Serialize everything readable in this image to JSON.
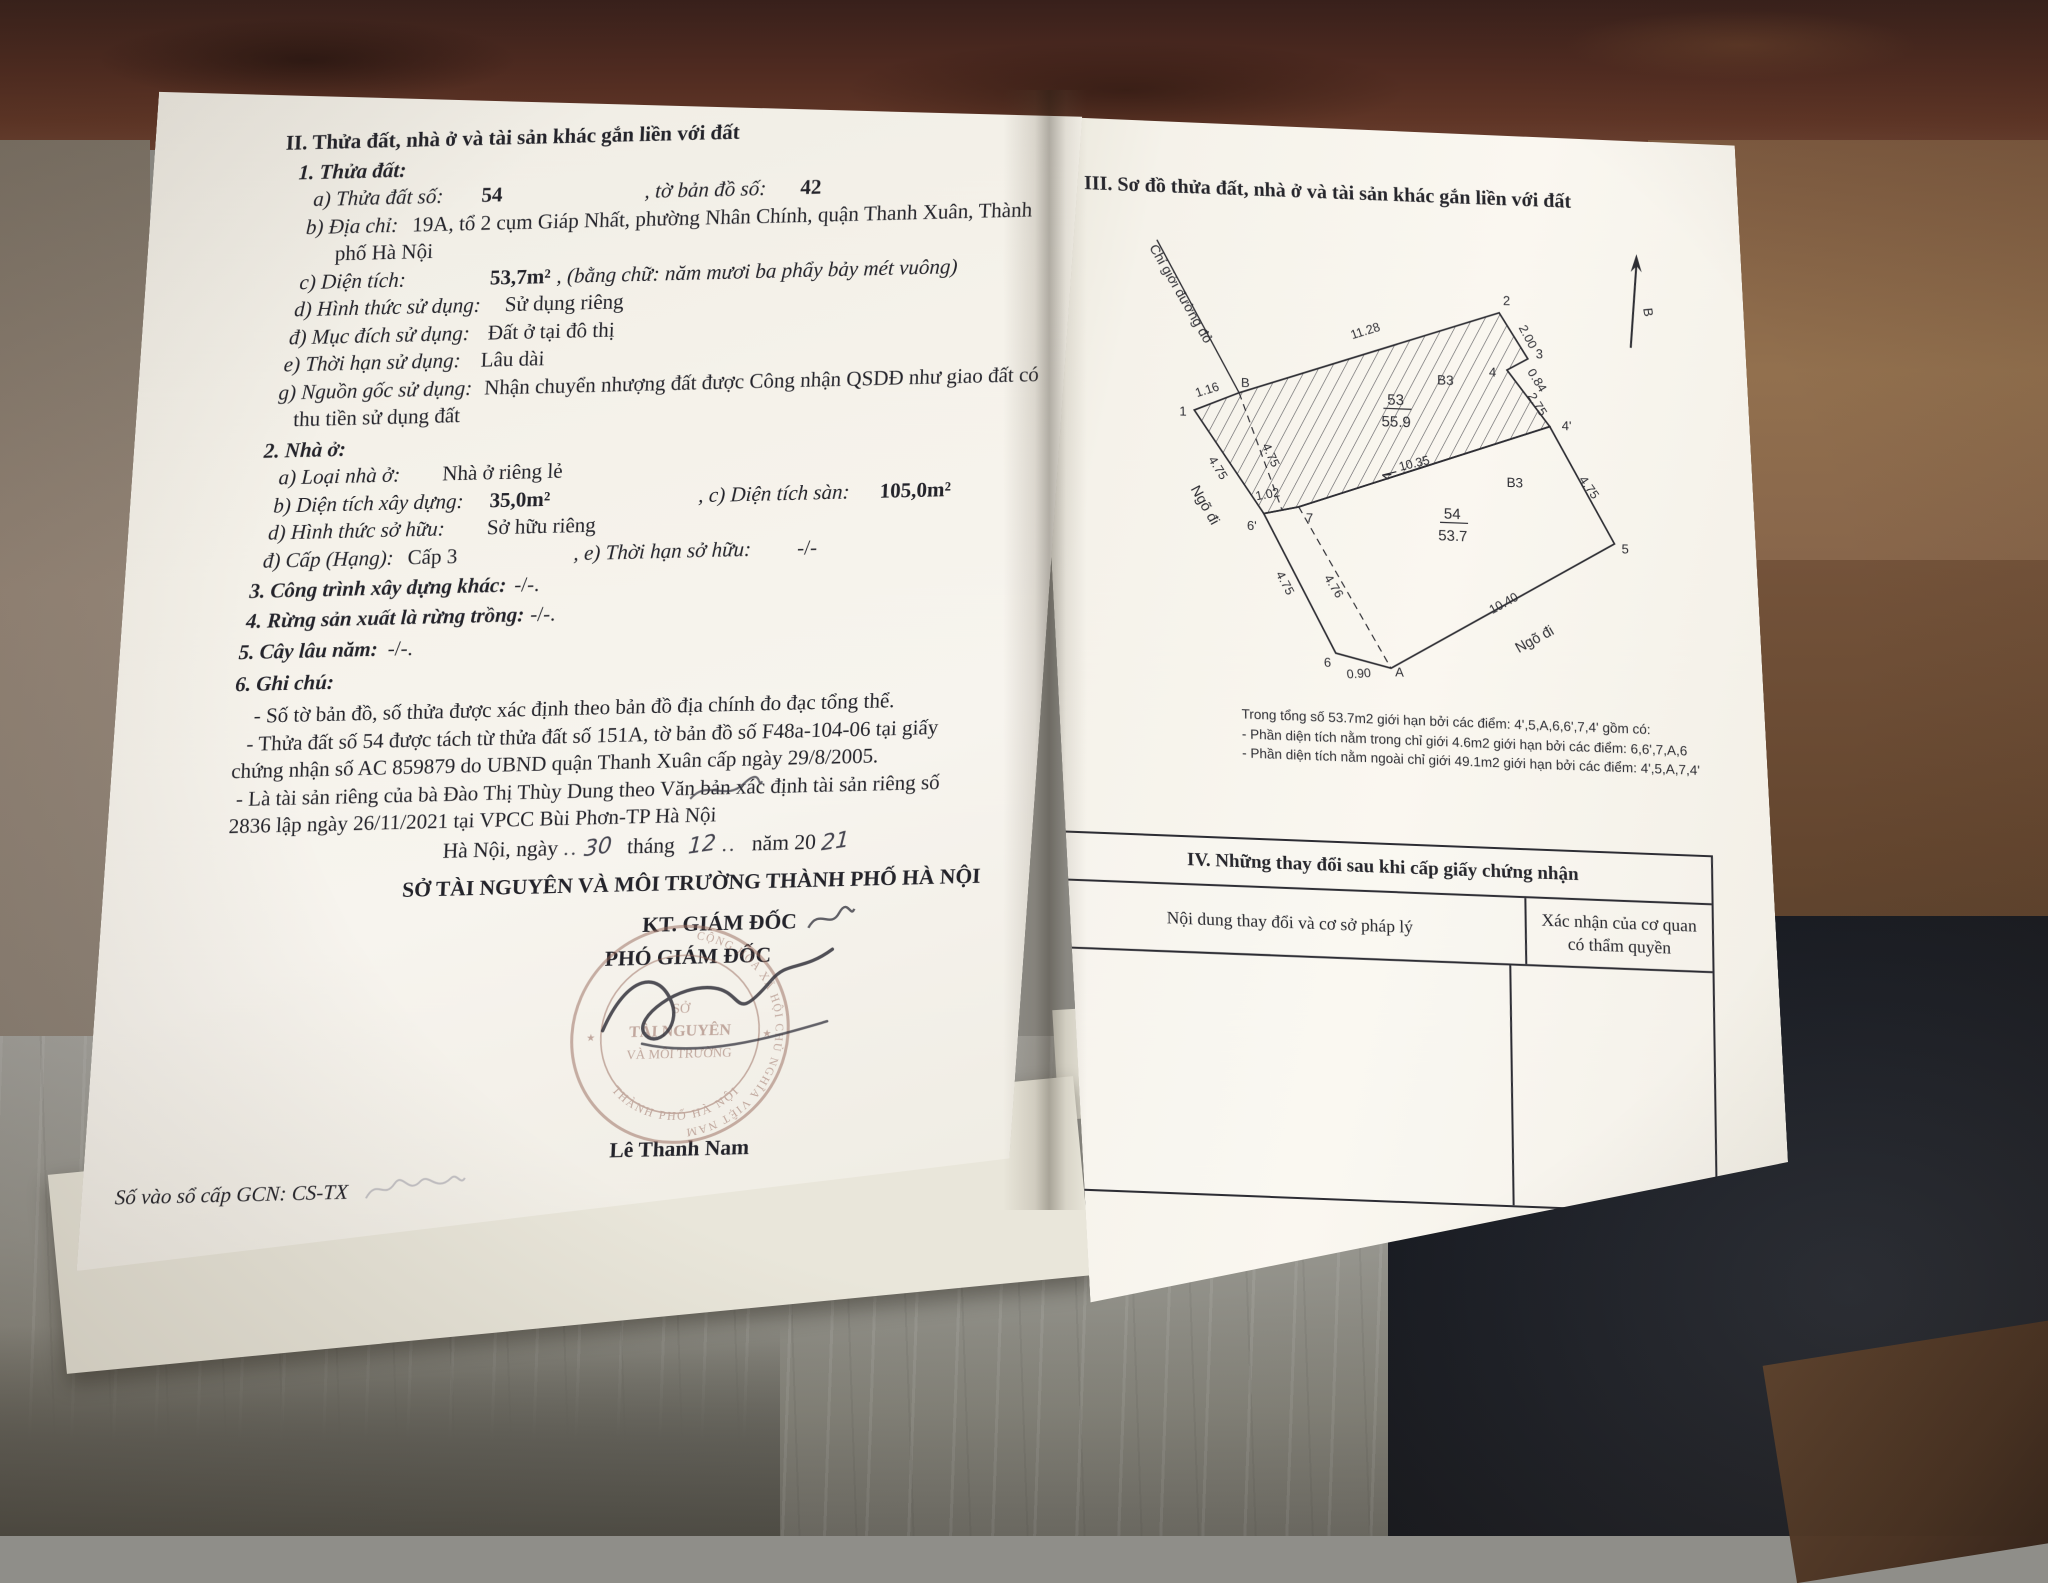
{
  "document": {
    "left": {
      "lines": [
        {
          "ind": 26,
          "segs": [
            {
              "t": "II. Thửa đất, nhà ở và tài sản khác gắn liền với đất",
              "st": "h"
            }
          ]
        },
        {
          "ind": 40,
          "mt": 2,
          "segs": [
            {
              "t": "1. Thửa đất:",
              "st": "sec"
            }
          ]
        },
        {
          "ind": 56,
          "segs": [
            {
              "t": "a) Thửa đất số:",
              "st": "lbl"
            },
            {
              "t": "54",
              "st": "val",
              "gap": 38
            },
            {
              "t": ", tờ bản đồ số:",
              "st": "lbl",
              "gap": 142
            },
            {
              "t": "42",
              "st": "val",
              "gap": 34
            }
          ]
        },
        {
          "ind": 50,
          "segs": [
            {
              "t": "b) Địa chỉ:",
              "st": "lbl"
            },
            {
              "t": "19A, tổ 2 cụm Giáp Nhất, phường Nhân Chính, quận Thanh Xuân, Thành",
              "st": "txt",
              "gap": 14
            }
          ]
        },
        {
          "ind": 80,
          "segs": [
            {
              "t": "phố Hà Nội",
              "st": "txt"
            }
          ]
        },
        {
          "ind": 46,
          "segs": [
            {
              "t": "c) Diện tích:",
              "st": "lbl"
            },
            {
              "t": "53,7m²",
              "st": "val",
              "gap": 84
            },
            {
              "t": ", (bằng chữ: năm mươi ba phẩy bảy mét vuông)",
              "st": "lbl",
              "gap": 6
            }
          ]
        },
        {
          "ind": 42,
          "segs": [
            {
              "t": "d) Hình thức sử dụng:",
              "st": "lbl"
            },
            {
              "t": "Sử dụng riêng",
              "st": "txt",
              "gap": 24
            }
          ]
        },
        {
          "ind": 38,
          "segs": [
            {
              "t": "đ) Mục đích sử dụng:",
              "st": "lbl"
            },
            {
              "t": "Đất ở tại đô thị",
              "st": "txt",
              "gap": 18
            }
          ]
        },
        {
          "ind": 34,
          "segs": [
            {
              "t": "e) Thời hạn sử dụng:",
              "st": "lbl"
            },
            {
              "t": "Lâu dài",
              "st": "txt",
              "gap": 20
            }
          ]
        },
        {
          "ind": 30,
          "segs": [
            {
              "t": "g) Nguồn gốc sử dụng:",
              "st": "lbl"
            },
            {
              "t": "Nhận chuyển nhượng đất được Công nhận QSDĐ như giao đất có",
              "st": "txt",
              "gap": 12
            }
          ]
        },
        {
          "ind": 46,
          "segs": [
            {
              "t": "thu tiền sử dụng đất",
              "st": "txt"
            }
          ]
        },
        {
          "ind": 18,
          "mt": 3,
          "segs": [
            {
              "t": "2. Nhà ở:",
              "st": "sec"
            }
          ]
        },
        {
          "ind": 34,
          "segs": [
            {
              "t": "a) Loại nhà ở:",
              "st": "lbl"
            },
            {
              "t": "Nhà ở riêng lẻ",
              "st": "txt",
              "gap": 42
            }
          ]
        },
        {
          "ind": 30,
          "segs": [
            {
              "t": "b) Diện tích xây dựng:",
              "st": "lbl"
            },
            {
              "t": "35,0m²",
              "st": "val",
              "gap": 26
            },
            {
              "t": ", c) Diện tích sàn:",
              "st": "lbl",
              "gap": 148
            },
            {
              "t": "105,0m²",
              "st": "val",
              "gap": 30
            }
          ]
        },
        {
          "ind": 26,
          "segs": [
            {
              "t": "d) Hình thức sở hữu:",
              "st": "lbl"
            },
            {
              "t": "Sở hữu riêng",
              "st": "txt",
              "gap": 42
            }
          ]
        },
        {
          "ind": 22,
          "segs": [
            {
              "t": "đ) Cấp (Hạng):",
              "st": "lbl"
            },
            {
              "t": "Cấp 3",
              "st": "txt",
              "gap": 14
            },
            {
              "t": ", e) Thời hạn sở hữu:",
              "st": "lbl",
              "gap": 116
            },
            {
              "t": "-/-",
              "st": "txt",
              "gap": 46
            }
          ]
        },
        {
          "ind": 10,
          "mt": 3,
          "segs": [
            {
              "t": "3. Công trình xây dựng khác:",
              "st": "sec"
            },
            {
              "t": "-/-.",
              "st": "txt",
              "gap": 8
            }
          ]
        },
        {
          "ind": 8,
          "mt": 2,
          "segs": [
            {
              "t": "4. Rừng sản xuất là rừng trồng:",
              "st": "sec"
            },
            {
              "t": "-/-.",
              "st": "txt",
              "gap": 6
            }
          ]
        },
        {
          "ind": 2,
          "mt": 4,
          "segs": [
            {
              "t": "5. Cây lâu năm:",
              "st": "sec"
            },
            {
              "t": "-/-.",
              "st": "txt",
              "gap": 10
            }
          ]
        },
        {
          "ind": 0,
          "mt": 4,
          "segs": [
            {
              "t": "6. Ghi chú:",
              "st": "sec"
            }
          ]
        },
        {
          "ind": 20,
          "mt": 5,
          "segs": [
            {
              "t": "- Số tờ bản đồ, số thửa được xác định theo bản đồ địa chính đo đạc tổng thể.",
              "st": "txt"
            }
          ]
        },
        {
          "ind": 14,
          "segs": [
            {
              "t": "- Thửa đất số 54 được tách từ thửa đất số 151A, tờ bản đồ số F48a-104-06 tại giấy",
              "st": "txt"
            }
          ]
        },
        {
          "ind": 0,
          "segs": [
            {
              "t": "chứng nhận số AC 859879 do UBND quận Thanh Xuân cấp ngày 29/8/2005.",
              "st": "txt"
            }
          ]
        },
        {
          "ind": 6,
          "segs": [
            {
              "t": "- Là tài sản riêng của bà Đào Thị Thùy Dung theo Văn bản xác định tài sản riêng số",
              "st": "txt"
            }
          ]
        },
        {
          "ind": 0,
          "segs": [
            {
              "t": "2836 lập ngày 26/11/2021 tại VPCC Bùi Phơn-TP Hà Nội",
              "st": "txt"
            }
          ]
        }
      ],
      "date": {
        "prefix": "Hà Nội, ngày",
        "dots1": "..",
        "day": "30",
        "between1": "tháng",
        "month": "12",
        "dots2": "..",
        "between2": "năm 20",
        "year": "21"
      },
      "issuer": "SỞ TÀI NGUYÊN VÀ MÔI TRƯỜNG THÀNH PHỐ HÀ NỘI",
      "title_kt": "KT. GIÁM ĐỐC",
      "title_pho": "PHÓ GIÁM ĐỐC",
      "signer": "Lê Thanh Nam",
      "seal": {
        "arc_top": "CỘNG HÒA XÃ HỘI CHỦ NGHĨA VIỆT NAM",
        "center1": "SỞ",
        "center2": "TÀI NGUYÊN",
        "center3": "VÀ MÔI TRƯỜNG",
        "arc_bottom": "THÀNH PHỐ HÀ NỘI"
      },
      "book_no": "Số vào sổ cấp GCN: CS-TX"
    },
    "right": {
      "section3_title": "III. Sơ đồ thửa đất, nhà ở và tài sản khác gắn liền với đất",
      "diagram": {
        "red_line": "Chỉ giới đường đỏ",
        "north": "B",
        "alley_left": "Ngõ đi",
        "alley_bottom": "Ngõ đi",
        "points": {
          "p1": "1",
          "pB": "B",
          "p2": "2",
          "p3": "3",
          "p4": "4",
          "p4p": "4'",
          "p5": "5",
          "p6": "6",
          "p6p": "6'",
          "p7": "7",
          "pA": "A"
        },
        "dims": {
          "d116": "1.16",
          "d1128": "11.28",
          "d200": "2.00",
          "d084": "0.84",
          "d275": "2.75",
          "d475_right": "4.75",
          "d475_left": "4.75",
          "d475_inner": "4.75",
          "d475_lower": "4.75",
          "d102": "1.02",
          "d1035": "10.35",
          "d476": "4.76",
          "d090": "0.90",
          "d1040": "10.40"
        },
        "parcels": {
          "p53_no": "53",
          "p53_area": "55.9",
          "p54_no": "54",
          "p54_area": "53.7",
          "b3_upper": "B3",
          "b3_lower": "B3"
        }
      },
      "notes": {
        "l1": "Trong tổng số 53.7m2 giới hạn bởi các điểm: 4',5,A,6,6',7,4' gồm có:",
        "l2": "- Phần diện tích nằm trong chỉ giới 4.6m2 giới hạn bởi các điểm: 6,6',7,A,6",
        "l3": "- Phần diện tích nằm ngoài chỉ giới 49.1m2 giới hạn bởi các điểm: 4',5,A,7,4'"
      },
      "table4": {
        "title": "IV. Những thay đổi sau khi cấp giấy chứng nhận",
        "col1": "Nội dung thay đổi và cơ sở pháp lý",
        "col2": "Xác nhận của cơ quan có thẩm quyền"
      }
    }
  }
}
